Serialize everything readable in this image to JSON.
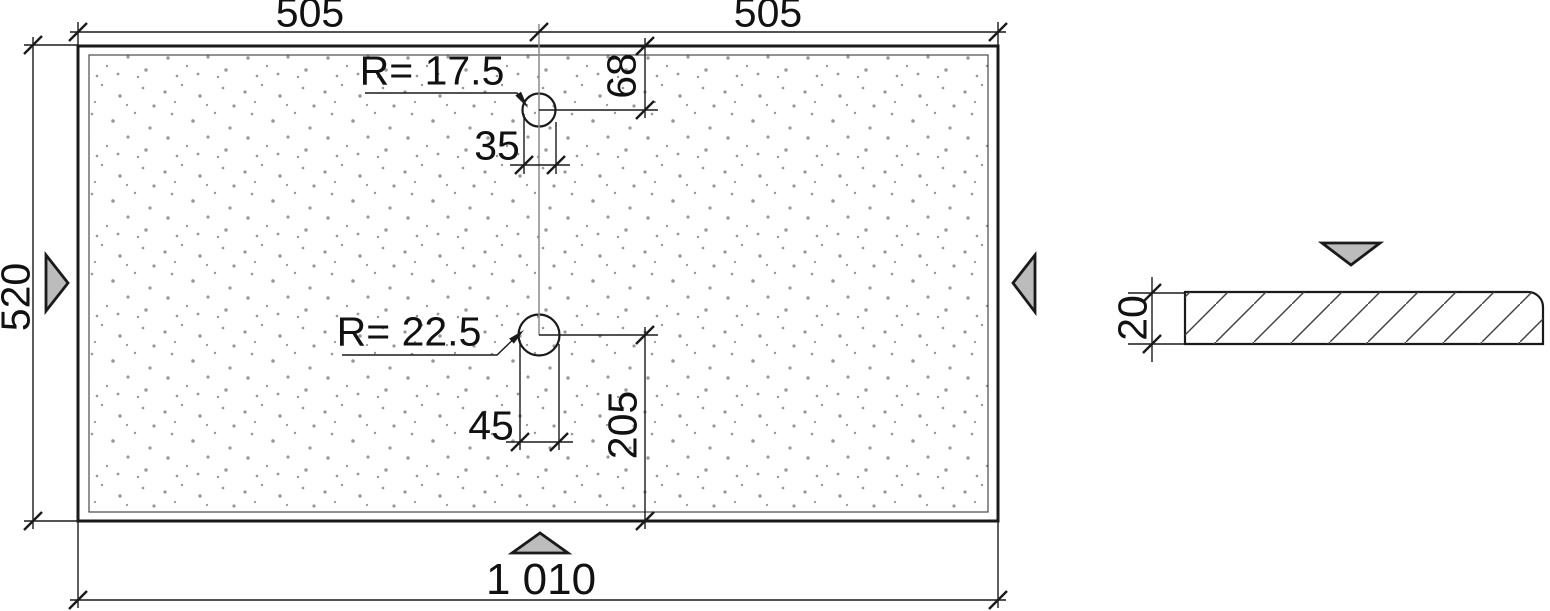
{
  "labels": {
    "top_left": "505",
    "top_right": "505",
    "bottom_total": "1 010",
    "height": "520",
    "hole1_radius": "R= 17.5",
    "hole1_offset": "68",
    "hole1_width": "35",
    "hole2_radius": "R= 22.5",
    "hole2_offset": "205",
    "hole2_width": "45",
    "section_thickness": "20"
  },
  "icons": {
    "view_arrows": [
      "view-arrow-left",
      "view-arrow-right",
      "view-arrow-bottom",
      "view-arrow-section"
    ]
  },
  "colors": {
    "line": "#1a1a1a",
    "centerline": "#8a8a8a",
    "view_arrow_fill": "#bcbcbc",
    "hatch": "#3f3f3f",
    "stipple": "#979797",
    "background": "#ffffff"
  }
}
